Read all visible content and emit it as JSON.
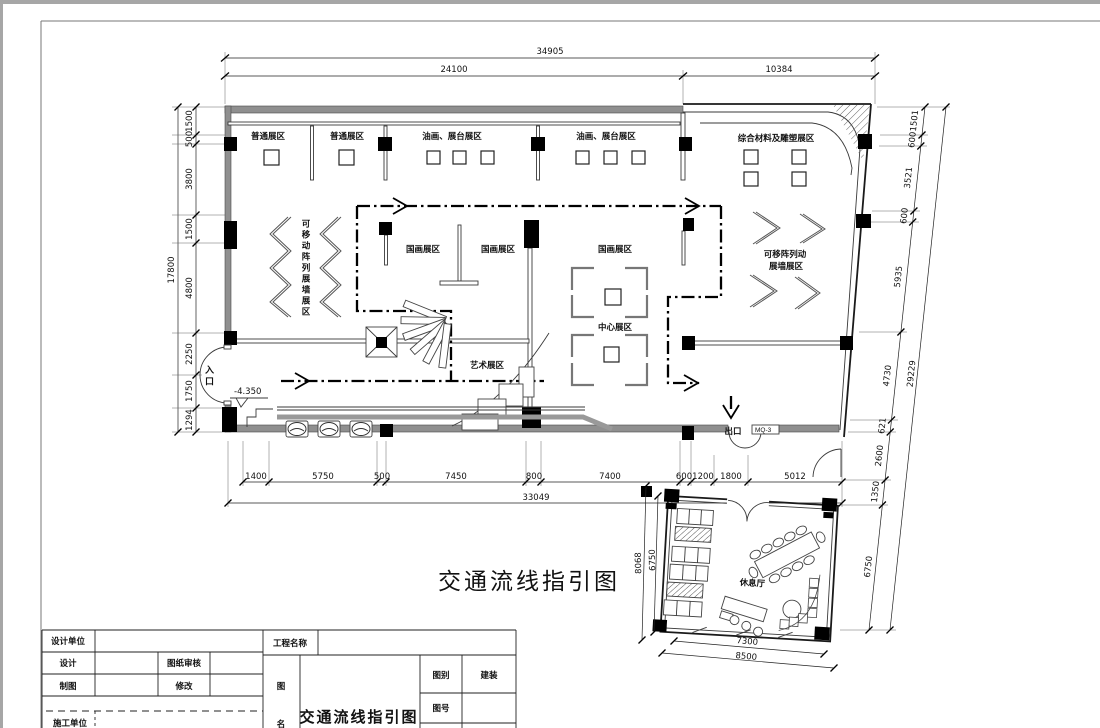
{
  "plan": {
    "main_title": "交通流线指引图",
    "rooms": {
      "general1": "普通展区",
      "general2": "普通展区",
      "oil1": "油画、展台展区",
      "oil2": "油画、展台展区",
      "composite": "综合材料及雕塑展区",
      "movable_left": "可移动阵列展墙展区",
      "guohua1": "国画展区",
      "guohua2": "国画展区",
      "guohua3": "国画展区",
      "center": "中心展区",
      "movable_right_line1": "可移阵列动",
      "movable_right_line2": "展墙展区",
      "art": "艺术展区",
      "lounge": "休息厅"
    },
    "labels": {
      "entry": "入口",
      "exit": "出口",
      "curtain_tag": "MQ-3",
      "level": "-4.350"
    }
  },
  "dims": {
    "top": {
      "total": "34905",
      "segments": [
        "24100",
        "10384"
      ]
    },
    "left": {
      "total": "17800",
      "segments": [
        "1500",
        "500",
        "3800",
        "1500",
        "4800",
        "2250",
        "1750",
        "1294"
      ]
    },
    "right": {
      "total": "29229",
      "segments": [
        "1501",
        "600",
        "3521",
        "600",
        "5935",
        "4730",
        "621",
        "2600",
        "1350",
        "6750"
      ]
    },
    "bottom": {
      "total": "33049",
      "segments": [
        "1400",
        "5750",
        "500",
        "7450",
        "800",
        "7400",
        "600",
        "1200",
        "1800",
        "5012"
      ]
    },
    "annex": {
      "left_outer": "8068",
      "left_inner": "6750",
      "bottom_inner": "7300",
      "bottom_outer": "8500"
    }
  },
  "titleblock": {
    "design_unit": "设计单位",
    "design": "设计",
    "review": "图纸审核",
    "draft": "制图",
    "revise": "修改",
    "construction_unit": "施工单位",
    "project_name": "工程名称",
    "drawing_name_label_1": "图",
    "drawing_name_label_2": "名",
    "drawing_title": "交通流线指引图",
    "category_label": "图别",
    "category_value": "建装",
    "number_label": "图号"
  },
  "colors": {
    "wall": "#8f8f8f",
    "line": "#000000",
    "hatch": "#666666"
  }
}
